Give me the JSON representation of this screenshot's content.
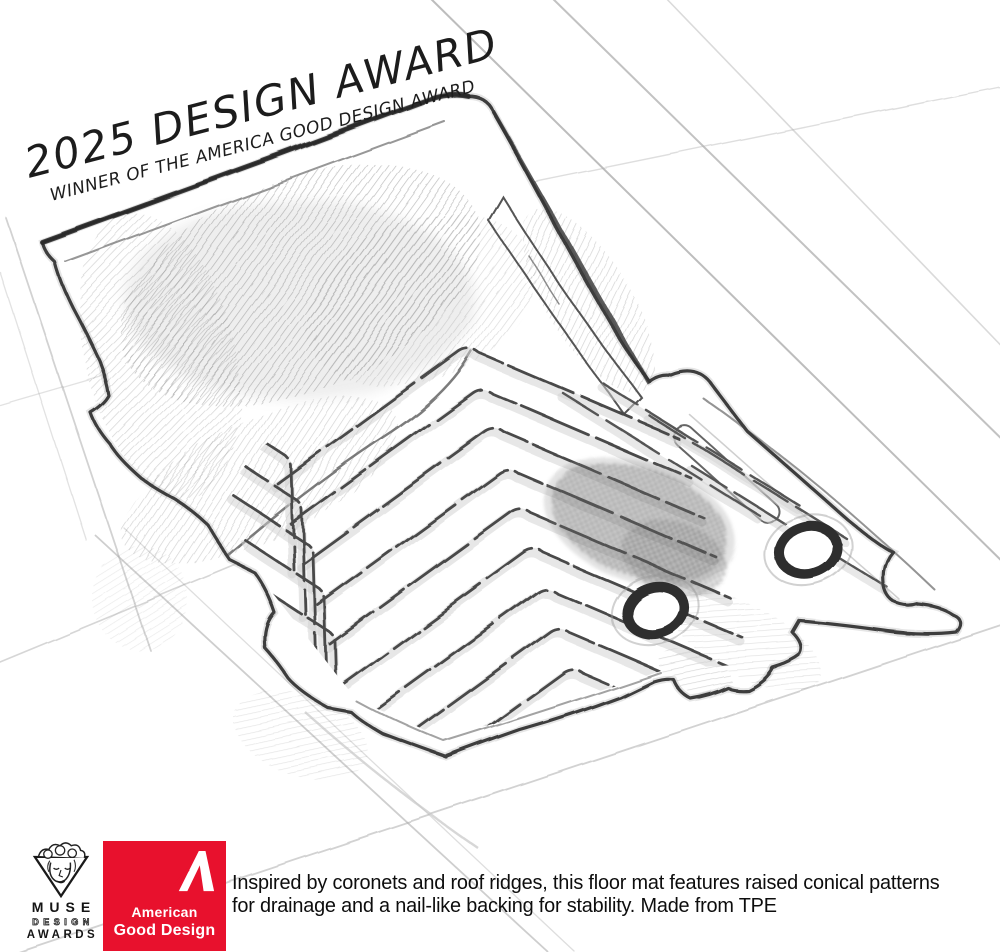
{
  "banner": {
    "title": "2025 DESIGN AWARD",
    "subtitle": "WINNER OF THE AMERICA GOOD DESIGN AWARD"
  },
  "badges": {
    "muse": {
      "name": "MUSE",
      "design": "DESIGN",
      "awards": "AWARDS"
    },
    "american_good_design": {
      "line1": "American",
      "line2": "Good Design",
      "background_color": "#e8112d",
      "text_color": "#ffffff"
    }
  },
  "caption": {
    "text": "Inspired by coronets and roof ridges, this floor mat features raised conical patterns for drainage and a nail-like backing for stability. Made from TPE"
  },
  "illustration": {
    "subject": "pencil sketch of a vehicle floor mat with chevron ridge pattern and two grommets"
  },
  "colors": {
    "background": "#ffffff",
    "pencil_dark": "#3c3c3c",
    "pencil_mid": "#8a8a8a",
    "pencil_light": "#c9c9c9",
    "handwriting": "#1c1c1c"
  }
}
